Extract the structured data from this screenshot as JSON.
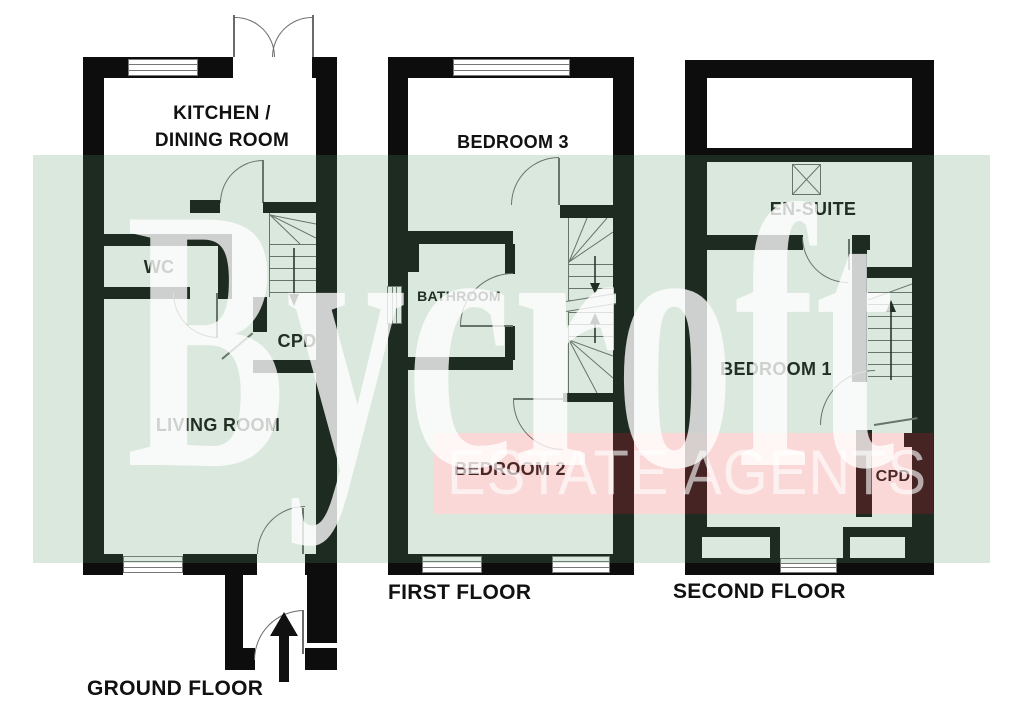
{
  "brand": {
    "name": "Bycroft",
    "tagline": "ESTATE AGENTS"
  },
  "colors": {
    "band_green": "#dbe8dd",
    "band_pink": "#f9d8d7",
    "wall": "#0d0d0d",
    "line": "#6b6b6b",
    "label_text": "#111111",
    "watermark_text": "#ffffff"
  },
  "floors": {
    "ground": {
      "title": "GROUND FLOOR",
      "rooms": {
        "kitchen_line1": "KITCHEN /",
        "kitchen_line2": "DINING ROOM",
        "wc": "WC",
        "cpd": "CPD",
        "living_room": "LIVING ROOM"
      }
    },
    "first": {
      "title": "FIRST FLOOR",
      "rooms": {
        "bedroom3": "BEDROOM 3",
        "bathroom": "BATHROOM",
        "bedroom2": "BEDROOM 2"
      }
    },
    "second": {
      "title": "SECOND FLOOR",
      "rooms": {
        "ensuite": "EN-SUITE",
        "bedroom1": "BEDROOM 1",
        "cpd": "CPD"
      }
    }
  }
}
